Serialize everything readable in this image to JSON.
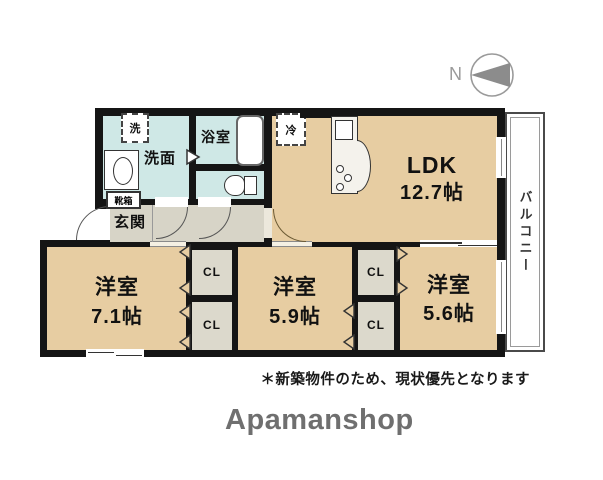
{
  "compass": {
    "label": "N"
  },
  "balcony": {
    "label": "バルコニー"
  },
  "rooms": {
    "ldk": {
      "name": "LDK",
      "size": "12.7帖"
    },
    "bedroom1": {
      "name": "洋室",
      "size": "7.1帖"
    },
    "bedroom2": {
      "name": "洋室",
      "size": "5.9帖"
    },
    "bedroom3": {
      "name": "洋室",
      "size": "5.6帖"
    },
    "washroom": {
      "name": "洗面"
    },
    "bathroom": {
      "name": "浴室"
    },
    "entrance": {
      "name": "玄関"
    }
  },
  "labels": {
    "washer": "洗",
    "fridge": "冷",
    "shoebox": "靴箱",
    "closet": "CL"
  },
  "footnote": "＊新築物件のため、現状優先となります",
  "brand": "Apamanshop",
  "colors": {
    "room_floor": "#e7cda2",
    "hall_floor": "#d7d4c7",
    "wet_floor": "#cfe8e6",
    "closet_floor": "#dcd9cc",
    "wall": "#151515",
    "brand_gray": "#6f6f6f"
  }
}
